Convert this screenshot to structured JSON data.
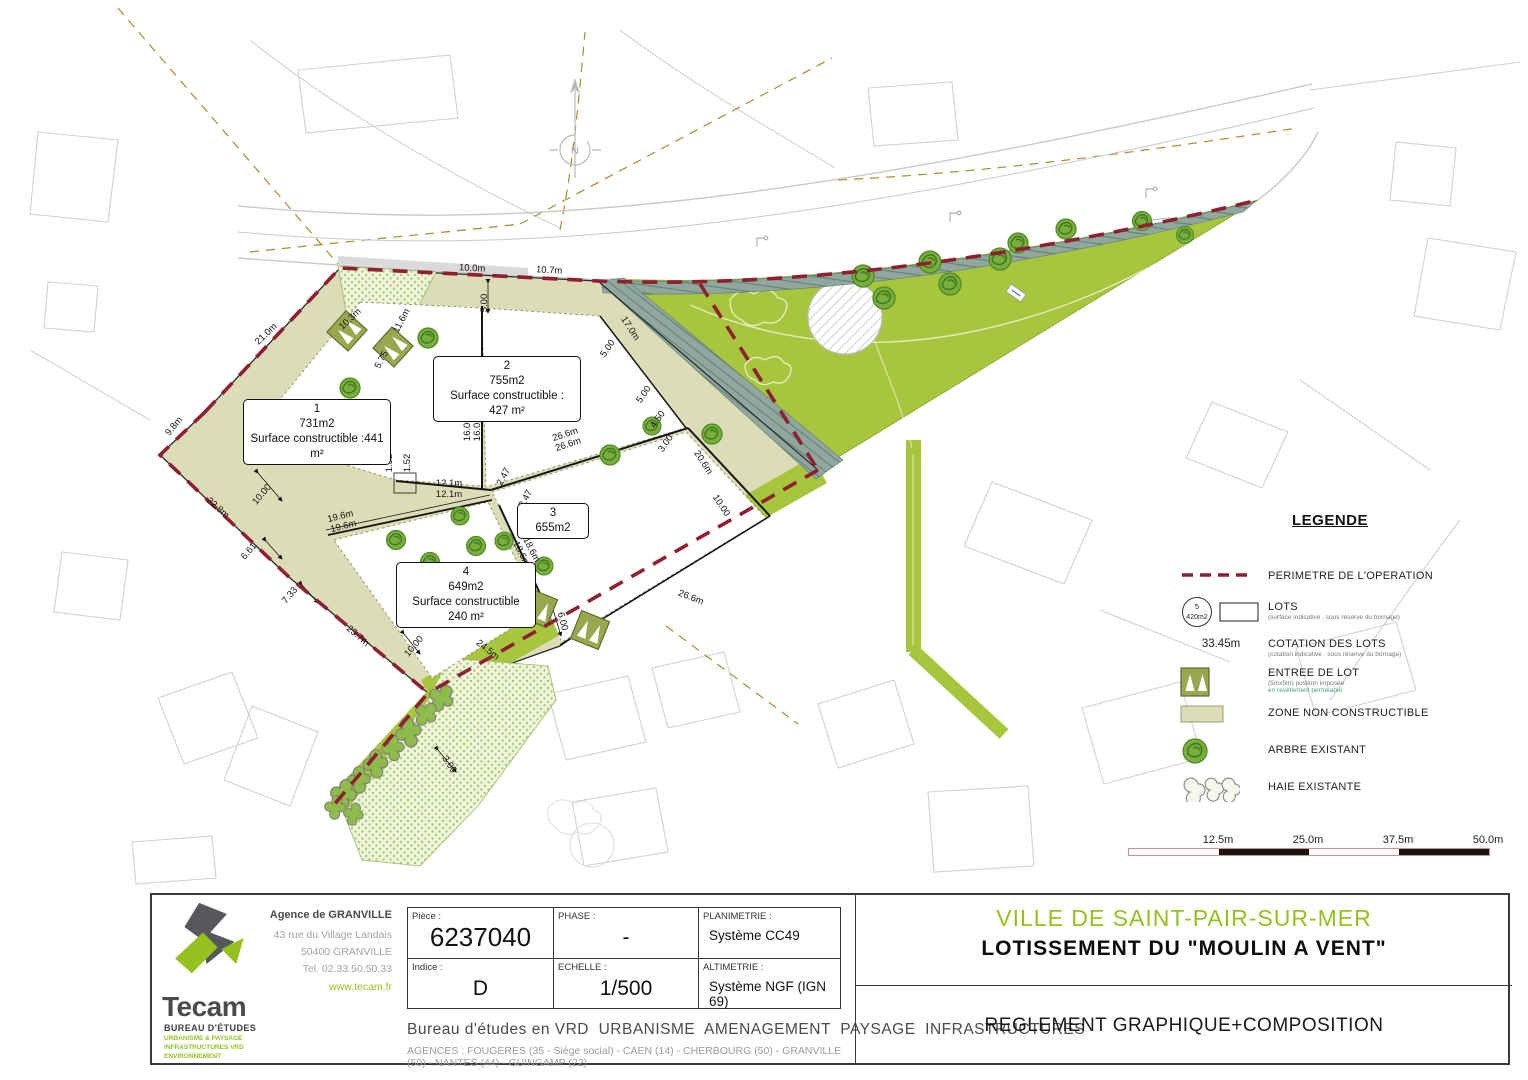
{
  "plan": {
    "north_label": "N",
    "lots": [
      {
        "num": "1",
        "area": "731m2",
        "surface": "Surface constructible :441 m²"
      },
      {
        "num": "2",
        "area": "755m2",
        "surface": "Surface constructible : 427 m²"
      },
      {
        "num": "3",
        "area": "655m2"
      },
      {
        "num": "4",
        "area": "649m2",
        "surface": "Surface constructible 240 m²"
      }
    ],
    "dims": [
      {
        "t": "10.0m",
        "x": 472,
        "y": 271,
        "r": 3
      },
      {
        "t": "10.7m",
        "x": 549,
        "y": 273,
        "r": 3
      },
      {
        "t": "21.0m",
        "x": 268,
        "y": 336,
        "r": -44
      },
      {
        "t": "9.8m",
        "x": 176,
        "y": 428,
        "r": -50
      },
      {
        "t": "22.8m",
        "x": 216,
        "y": 510,
        "r": 41
      },
      {
        "t": "25.7m",
        "x": 356,
        "y": 638,
        "r": 41
      },
      {
        "t": "10.3m",
        "x": 352,
        "y": 321,
        "r": -44
      },
      {
        "t": "11.6m",
        "x": 404,
        "y": 322,
        "r": -62
      },
      {
        "t": "5.75",
        "x": 384,
        "y": 361,
        "r": -62
      },
      {
        "t": "16.0m",
        "x": 470,
        "y": 428,
        "r": -90
      },
      {
        "t": "16.0m",
        "x": 480,
        "y": 428,
        "r": -90
      },
      {
        "t": "12.1m",
        "x": 449,
        "y": 486,
        "r": 0
      },
      {
        "t": "12.1m",
        "x": 449,
        "y": 497,
        "r": 0
      },
      {
        "t": "26.6m",
        "x": 566,
        "y": 437,
        "r": -18
      },
      {
        "t": "26.6m",
        "x": 569,
        "y": 447,
        "r": -18
      },
      {
        "t": "19.6m",
        "x": 341,
        "y": 519,
        "r": -14
      },
      {
        "t": "19.6m",
        "x": 344,
        "y": 529,
        "r": -14
      },
      {
        "t": "18.6m",
        "x": 519,
        "y": 555,
        "r": 63
      },
      {
        "t": "18.6m",
        "x": 529,
        "y": 551,
        "r": 63
      },
      {
        "t": "17.0m",
        "x": 628,
        "y": 330,
        "r": 57
      },
      {
        "t": "5.00",
        "x": 487,
        "y": 303,
        "r": -90
      },
      {
        "t": "5.00",
        "x": 610,
        "y": 350,
        "r": -55
      },
      {
        "t": "5.00",
        "x": 646,
        "y": 396,
        "r": -55
      },
      {
        "t": "4.50",
        "x": 660,
        "y": 421,
        "r": -55
      },
      {
        "t": "3.00",
        "x": 668,
        "y": 445,
        "r": -55
      },
      {
        "t": "20.6m",
        "x": 701,
        "y": 464,
        "r": 57
      },
      {
        "t": "10.00",
        "x": 719,
        "y": 507,
        "r": 57
      },
      {
        "t": "26.6m",
        "x": 690,
        "y": 600,
        "r": 21
      },
      {
        "t": "24.5m",
        "x": 486,
        "y": 652,
        "r": 38
      },
      {
        "t": "6.00",
        "x": 560,
        "y": 622,
        "r": 75
      },
      {
        "t": "3.00",
        "x": 447,
        "y": 766,
        "r": 55
      },
      {
        "t": "10.00",
        "x": 264,
        "y": 496,
        "r": -50
      },
      {
        "t": "6.61",
        "x": 251,
        "y": 553,
        "r": -50
      },
      {
        "t": "7.33",
        "x": 292,
        "y": 597,
        "r": -50
      },
      {
        "t": "10.00",
        "x": 416,
        "y": 648,
        "r": -50
      },
      {
        "t": "1.52",
        "x": 392,
        "y": 463,
        "r": -90
      },
      {
        "t": "1.52",
        "x": 410,
        "y": 463,
        "r": -90
      },
      {
        "t": "2.47",
        "x": 506,
        "y": 478,
        "r": -62
      },
      {
        "t": "2.47",
        "x": 528,
        "y": 500,
        "r": -62
      }
    ]
  },
  "legend": {
    "title": "LEGENDE",
    "items": [
      {
        "label": "PERIMETRE DE L'OPERATION",
        "icon": "perimeter-dash-icon"
      },
      {
        "label": "LOTS",
        "sub": "(surface indicative , sous réserve du bornage)",
        "icon": "lot-icon",
        "badge_num": "5",
        "badge_area": "420m2"
      },
      {
        "label": "COTATION DES LOTS",
        "sub": "(cotation indicative , sous réserve du bornage)",
        "icon": "cotation-icon",
        "icon_text": "33.45m"
      },
      {
        "label": "ENTREE DE LOT",
        "sub": "(5mx5m) position imposée",
        "sub2": "en revêtement perméable",
        "icon": "entry-icon"
      },
      {
        "label": "ZONE NON CONSTRUCTIBLE",
        "icon": "zone-icon"
      },
      {
        "label": "ARBRE EXISTANT",
        "icon": "tree-icon"
      },
      {
        "label": "HAIE EXISTANTE",
        "icon": "hedge-icon"
      }
    ]
  },
  "scalebar": {
    "labels": [
      "12.5m",
      "25.0m",
      "37.5m",
      "50.0m"
    ]
  },
  "titleblock": {
    "logo_name": "Tecam",
    "logo_sub": "BUREAU D'ÉTUDES",
    "tag1": "URBANISME & PAYSAGE",
    "tag2": "INFRASTRUCTURES VRD",
    "tag3": "ENVIRONNEMENT",
    "agency_title": "Agence de GRANVILLE",
    "address1": "43 rue du Village Landais",
    "address2": "50400 GRANVILLE",
    "phone": "Tel. 02.33.50.50.33",
    "website": "www.tecam.fr",
    "piece_label": "Pièce :",
    "piece": "6237040",
    "phase_label": "PHASE :",
    "phase": "-",
    "plani_label": "PLANIMETRIE :",
    "plani": "Système CC49",
    "indice_label": "Indice :",
    "indice": "D",
    "echelle_label": "ECHELLE :",
    "echelle": "1/500",
    "alti_label": "ALTIMETRIE :",
    "alti": "Système NGF (IGN 69)",
    "services": "Bureau d'études en VRD  URBANISME  AMENAGEMENT  PAYSAGE  INFRASTRUCTURES",
    "agences": "AGENCES :  FOUGERES (35 - Siège social) - CAEN (14) - CHERBOURG (50) - GRANVILLE (50) - NANTES (44) - GUINGAMP (22)",
    "city": "VILLE DE SAINT-PAIR-SUR-MER",
    "project": "LOTISSEMENT DU \"MOULIN A VENT\"",
    "doc_title": "REGLEMENT GRAPHIQUE+COMPOSITION"
  },
  "colors": {
    "brand_green": "#95c11f",
    "park_green": "#a7c63e",
    "perimeter_red": "#8e2032",
    "zone_beige": "#dcddb6",
    "hatch_teal": "#8fa79d"
  }
}
